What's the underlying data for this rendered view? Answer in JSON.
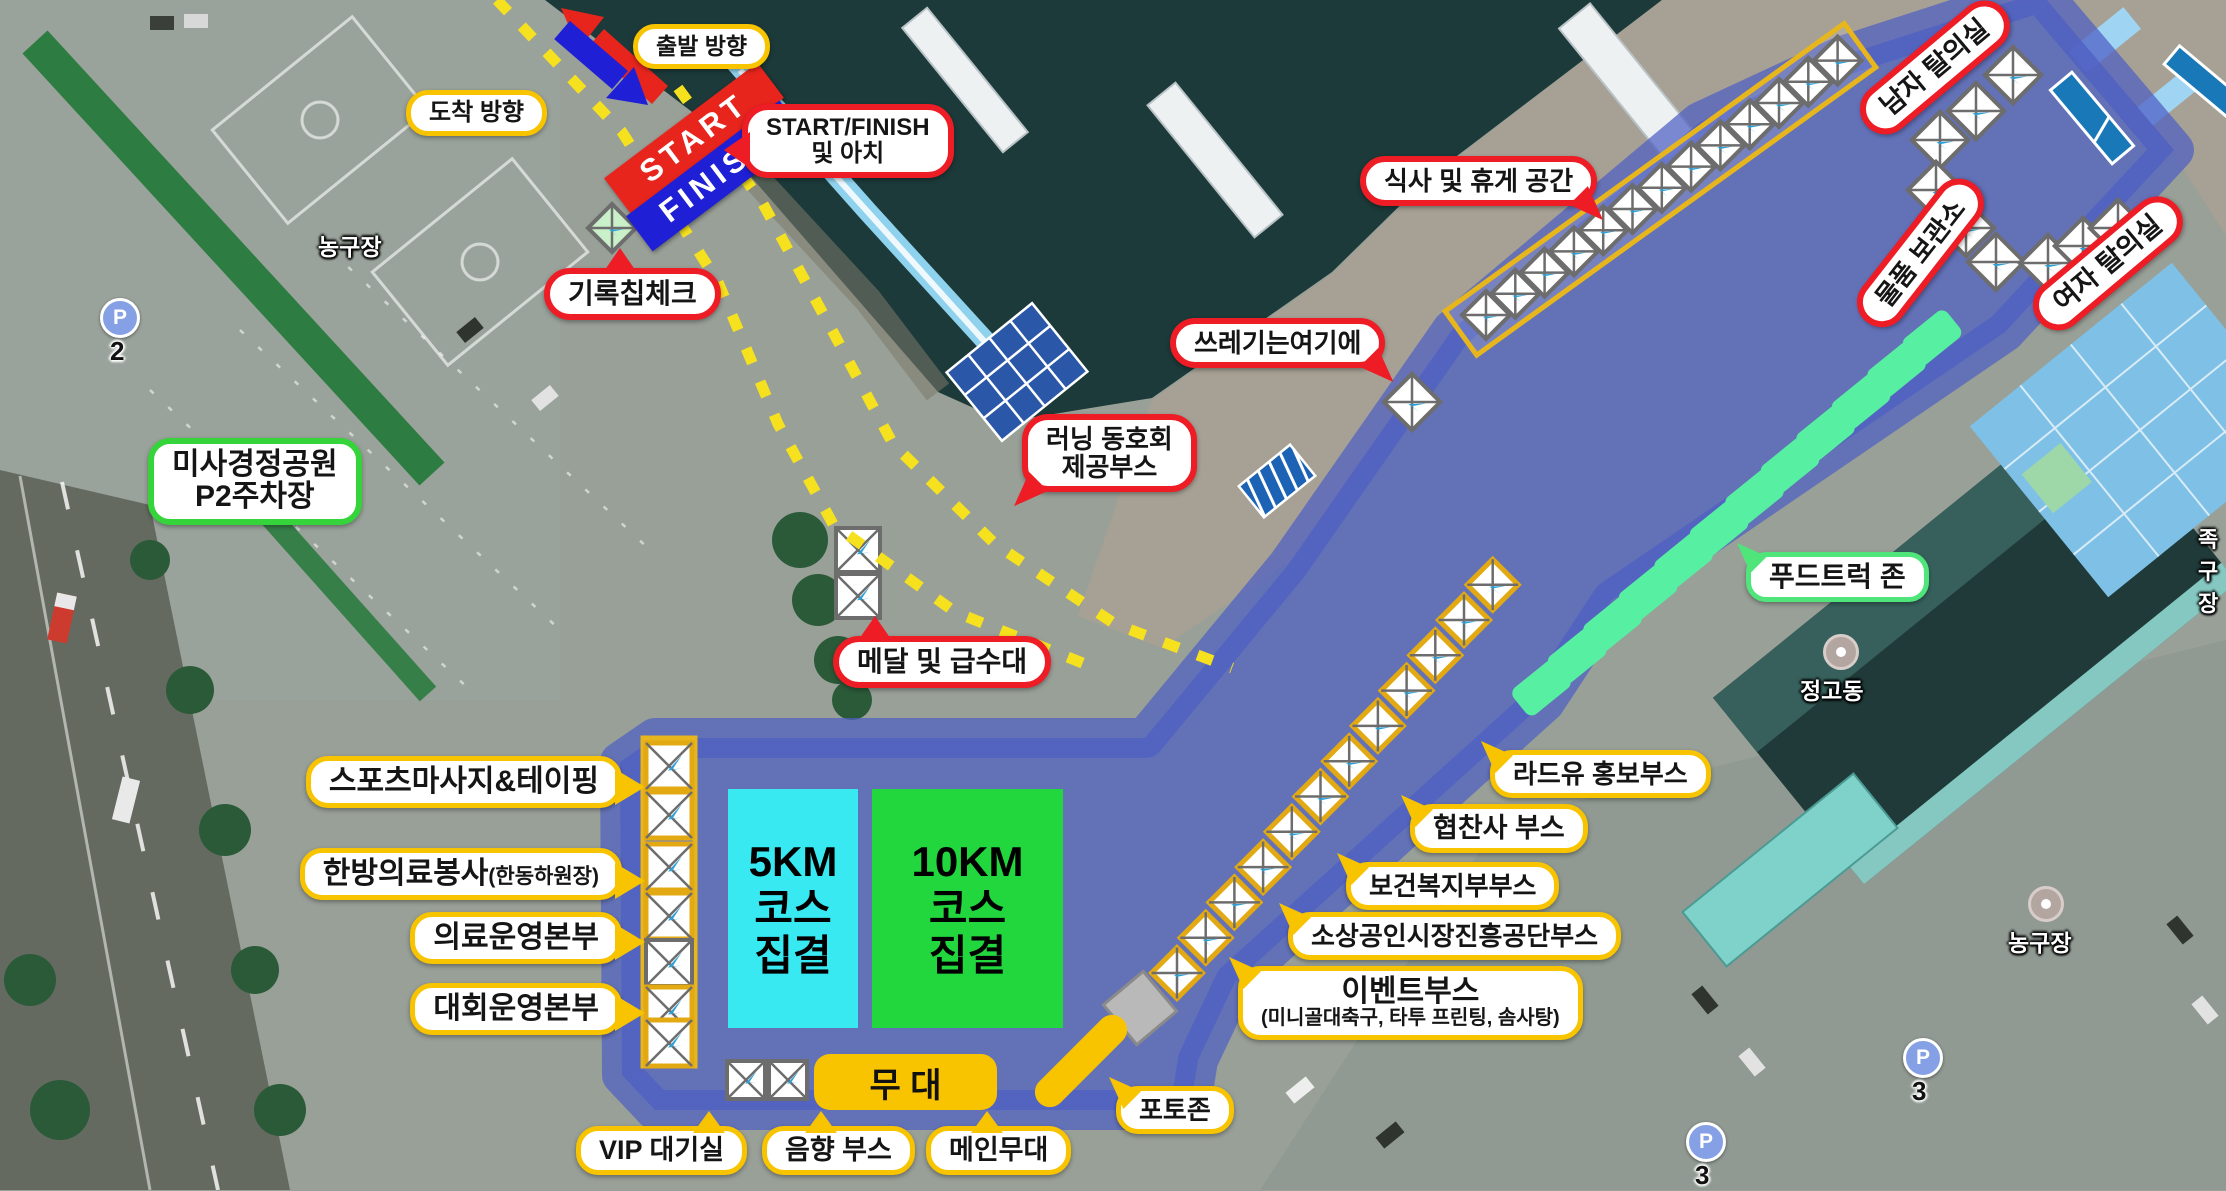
{
  "colors": {
    "callout_red": "#ee1c25",
    "callout_yellow": "#f8c400",
    "callout_green": "#35d43a",
    "callout_mint": "#4fe57a",
    "zone_blue": "#4d5ec4",
    "km5_cyan": "#38e9f2",
    "km10_green": "#22d73e",
    "start_red": "#e8251d",
    "finish_blue": "#1f1fd6",
    "foodtruck_mint": "#57efa1"
  },
  "course": {
    "depart": "출발 방향",
    "arrive": "도착 방향",
    "start_banner": "START",
    "finish_banner": "FINISH"
  },
  "callouts": {
    "start_finish_arch": {
      "line1": "START/FINISH",
      "line2": "및 아치"
    },
    "chip_check": "기록칩체크",
    "parking": {
      "line1": "미사경정공원",
      "line2": "P2주차장"
    },
    "meal_rest": "식사 및 휴게 공간",
    "trash": "쓰레기는여기에",
    "running_club": {
      "line1": "러닝 동호회",
      "line2": "제공부스"
    },
    "medal_water": "메달 및 급수대",
    "mens_changing": "남자 탈의실",
    "storage": "물품 보관소",
    "womens_changing": "여자 탈의실",
    "food_truck": "푸드트럭 존",
    "sports_massage": "스포츠마사지&테이핑",
    "oriental_medical": {
      "main": "한방의료봉사",
      "paren": "(한동하원장)"
    },
    "medical_hq": "의료운영본부",
    "event_hq": "대회운영본부",
    "stage": "무 대",
    "vip": "VIP 대기실",
    "sound": "음향 부스",
    "main_stage": "메인무대",
    "photo_zone": "포토존",
    "radyu": "라드유 홍보부스",
    "sponsor": "협찬사 부스",
    "welfare": "보건복지부부스",
    "small_biz": "소상공인시장진흥공단부스",
    "event_booth": {
      "line1": "이벤트부스",
      "line2": "(미니골대축구, 타투 프린팅, 솜사탕)"
    }
  },
  "zones": {
    "km5": {
      "line1": "5KM",
      "line2": "코스",
      "line3": "집결"
    },
    "km10": {
      "line1": "10KM",
      "line2": "코스",
      "line3": "집결"
    }
  },
  "map_labels": {
    "basketball_top": "농구장",
    "basketball_right": "농구장",
    "jeonggodong": "정고동",
    "edge_partial": "족구장",
    "p_letter": "P",
    "p2_num": "2",
    "p3_num": "3"
  }
}
